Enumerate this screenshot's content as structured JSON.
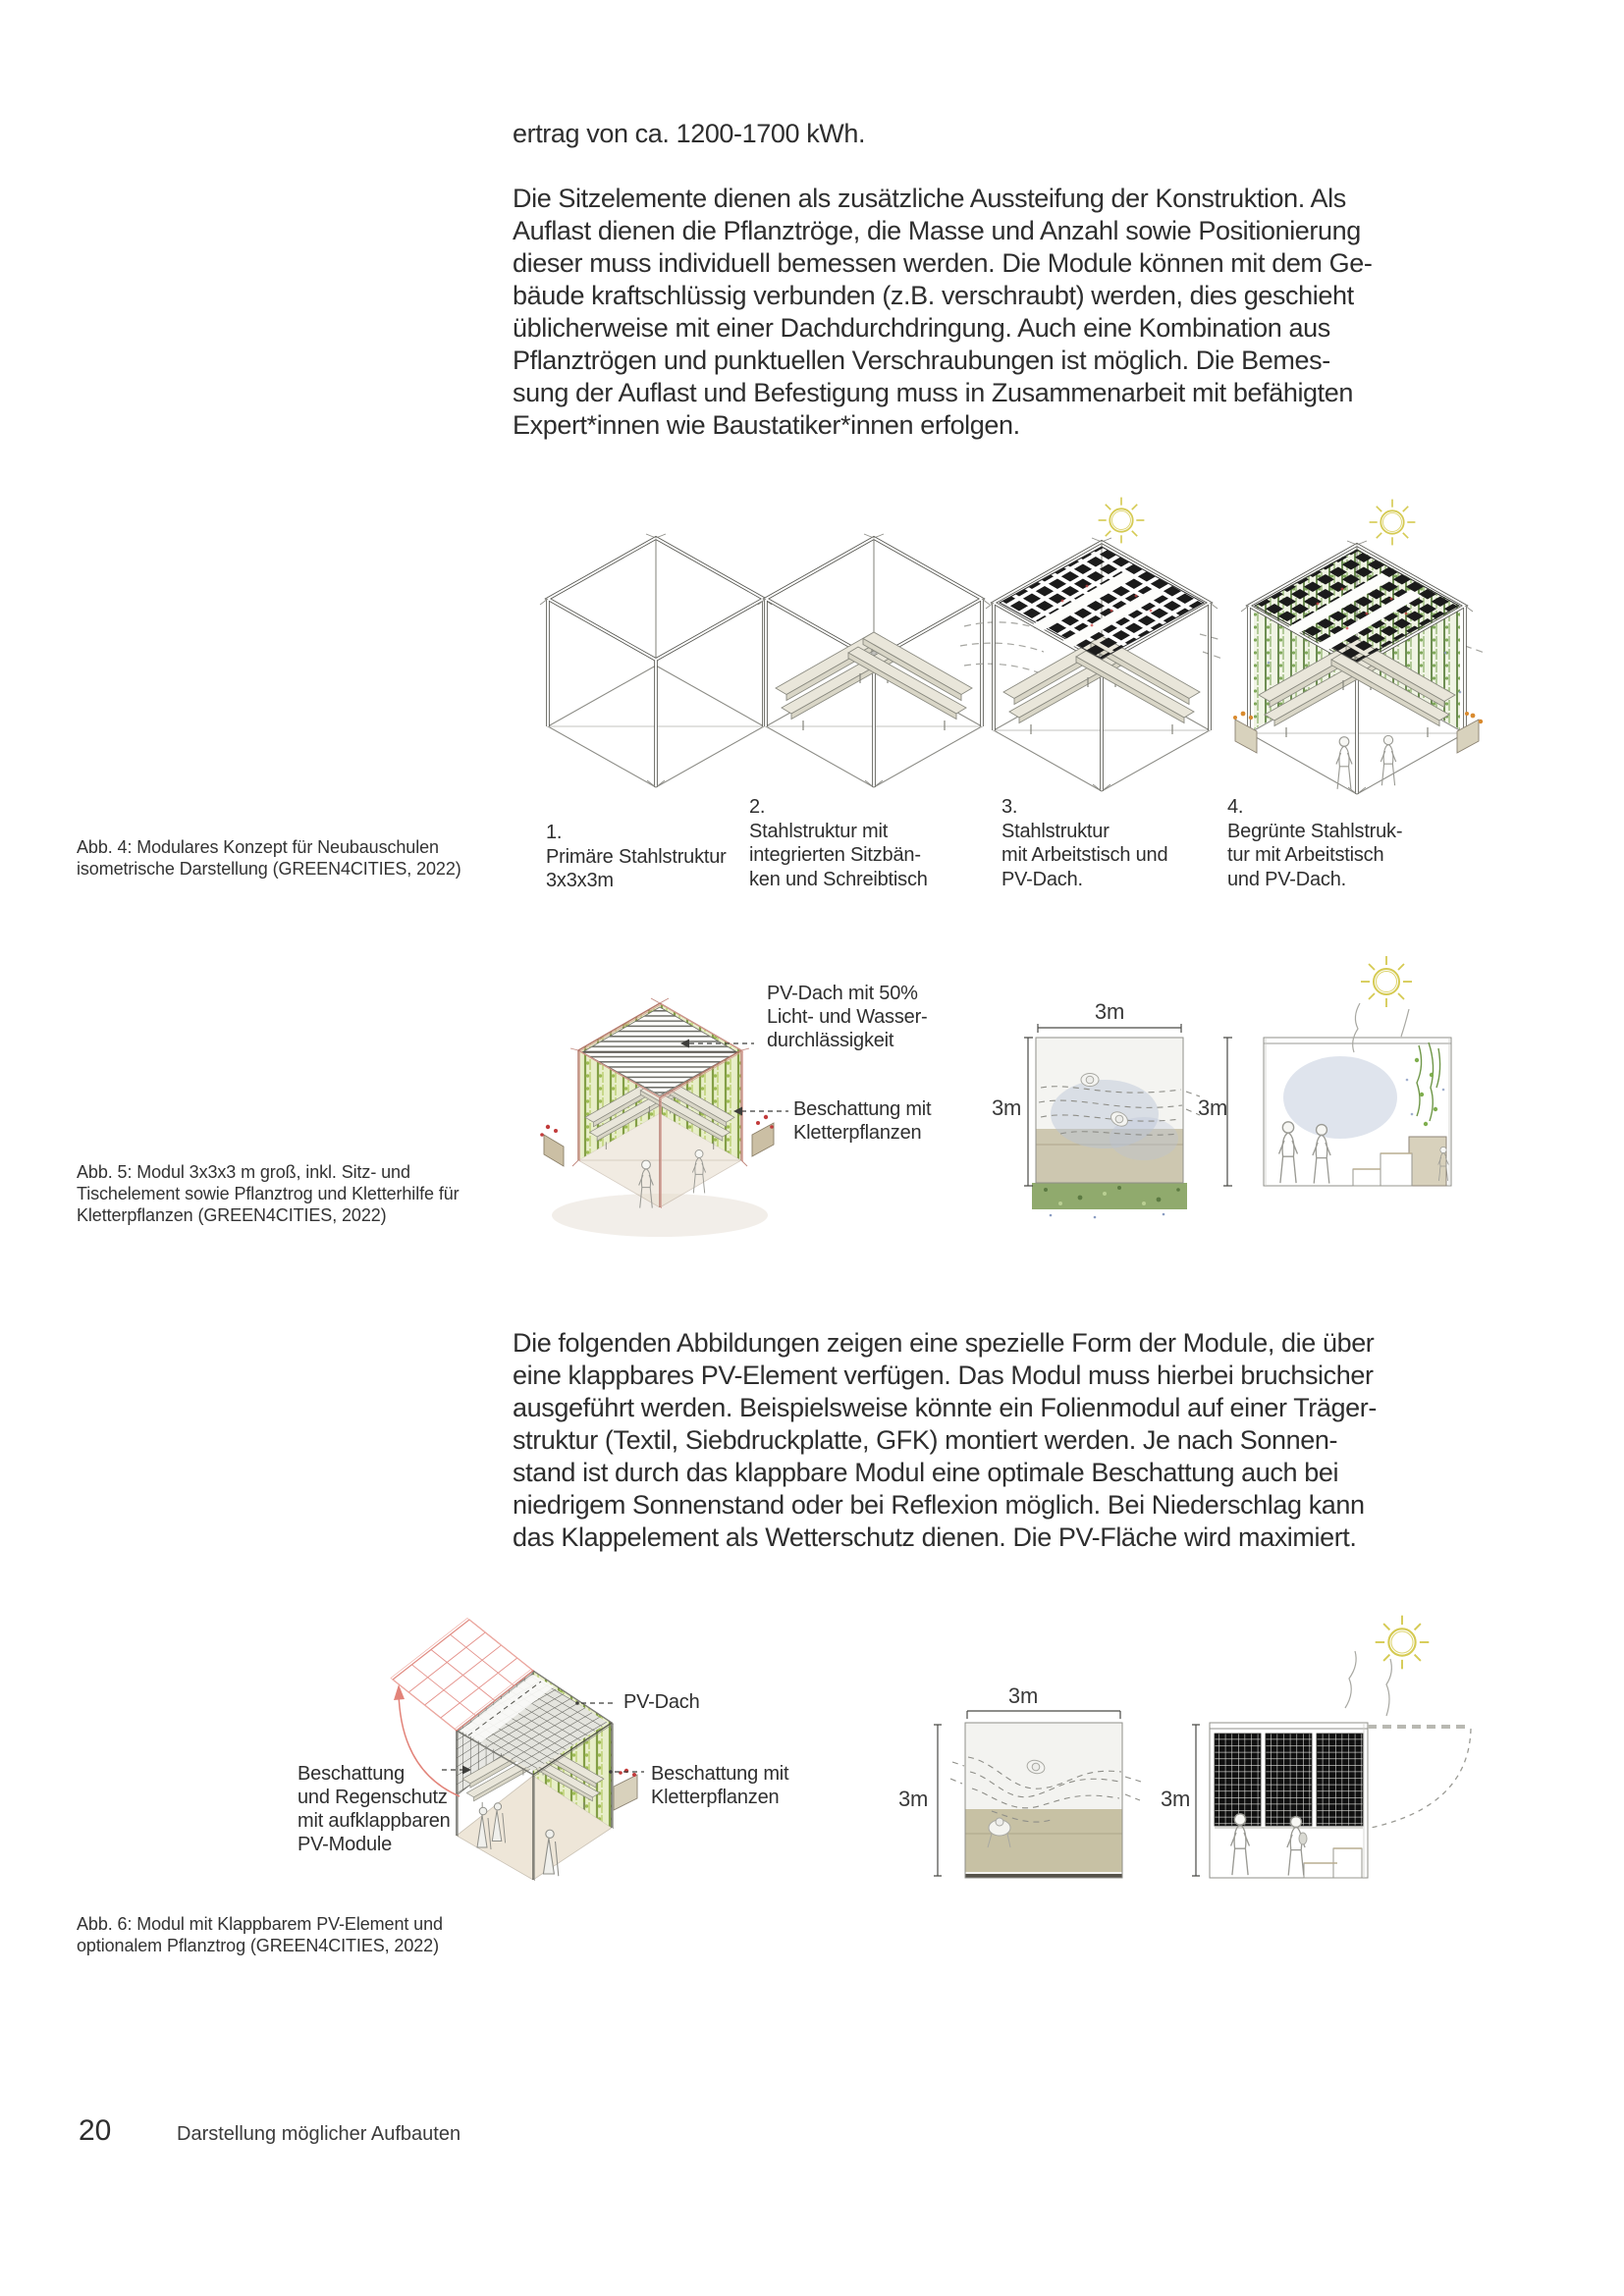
{
  "page": {
    "number": "20",
    "footer_label": "Darstellung möglicher Aufbauten"
  },
  "body": {
    "p1": "ertrag von ca. 1200-1700 kWh.",
    "p2": [
      "Die Sitzelemente dienen als zusätzliche Aussteifung der Konstruktion. Als",
      "Auflast dienen die Pflanztröge, die Masse und Anzahl sowie Positionierung",
      "dieser muss individuell bemessen werden. Die Module können mit dem Ge-",
      "bäude kraftschlüssig verbunden (z.B. verschraubt) werden, dies geschieht",
      "üblicherweise mit einer Dachdurchdringung. Auch eine Kombination aus",
      "Pflanztrögen und punktuellen Verschraubungen ist möglich. Die Bemes-",
      "sung der Auflast und Befestigung muss in Zusammenarbeit mit befähigten",
      "Expert*innen wie Baustatiker*innen erfolgen."
    ],
    "p3": [
      "Die folgenden Abbildungen zeigen eine spezielle Form der Module, die über",
      "eine klappbares PV-Element verfügen. Das Modul muss hierbei bruchsicher",
      "ausgeführt werden. Beispielsweise könnte ein Folienmodul auf einer Träger-",
      "struktur (Textil, Siebdruckplatte, GFK) montiert werden. Je nach Sonnen-",
      "stand ist durch das klappbare Modul eine optimale Beschattung auch bei",
      "niedrigem Sonnenstand oder bei Reflexion möglich. Bei Niederschlag kann",
      "das Klappelement als Wetterschutz dienen. Die PV-Fläche wird maximiert."
    ]
  },
  "abb4": {
    "caption": [
      "Abb. 4: Modulares Konzept für Neubauschulen",
      "isometrische Darstellung (GREEN4CITIES, 2022)"
    ],
    "steps": [
      {
        "lines": [
          "1.",
          "Primäre Stahlstruktur",
          "3x3x3m"
        ]
      },
      {
        "lines": [
          "2.",
          "Stahlstruktur mit",
          "integrierten Sitzbän-",
          "ken und Schreibtisch"
        ]
      },
      {
        "lines": [
          "3.",
          "Stahlstruktur",
          "mit Arbeitstisch und",
          "PV-Dach."
        ]
      },
      {
        "lines": [
          "4.",
          "Begrünte Stahlstruk-",
          "tur mit Arbeitstisch",
          "und PV-Dach."
        ]
      }
    ]
  },
  "abb5": {
    "caption": [
      "Abb. 5: Modul 3x3x3 m groß,  inkl. Sitz- und",
      "Tischelement sowie Pflanztrog und Kletterhilfe für",
      "Kletterpflanzen (GREEN4CITIES, 2022)"
    ],
    "annotation_pv_roof": [
      "PV-Dach mit 50%",
      "Licht- und Wasser-",
      "durchlässigkeit"
    ],
    "annotation_shading": [
      "Beschattung mit",
      "Kletterpflanzen"
    ],
    "dim_width": "3m",
    "dim_height": "3m",
    "dim_section_height": "3m"
  },
  "abb6": {
    "caption": [
      "Abb. 6: Modul mit Klappbarem PV-Element und",
      "optionalem Pflanztrog (GREEN4CITIES, 2022)"
    ],
    "annotation_foldable": [
      "Beschattung",
      "und Regenschutz",
      "mit aufklappbaren",
      "PV-Module"
    ],
    "annotation_pv_roof": "PV-Dach",
    "annotation_shading": [
      "Beschattung mit",
      "Kletterpflanzen"
    ],
    "dim_width": "3m",
    "dim_height": "3m",
    "dim_section_height": "3m"
  },
  "colors": {
    "pv_black": "#1b1b1b",
    "plant_green": "#6f9748",
    "bright_green": "#9cb93f",
    "frame_red": "#b4756a",
    "sun_yellow": "#d5ca52",
    "khaki": "#c7c1a4",
    "cloud_blue": "#b9c4d8"
  }
}
